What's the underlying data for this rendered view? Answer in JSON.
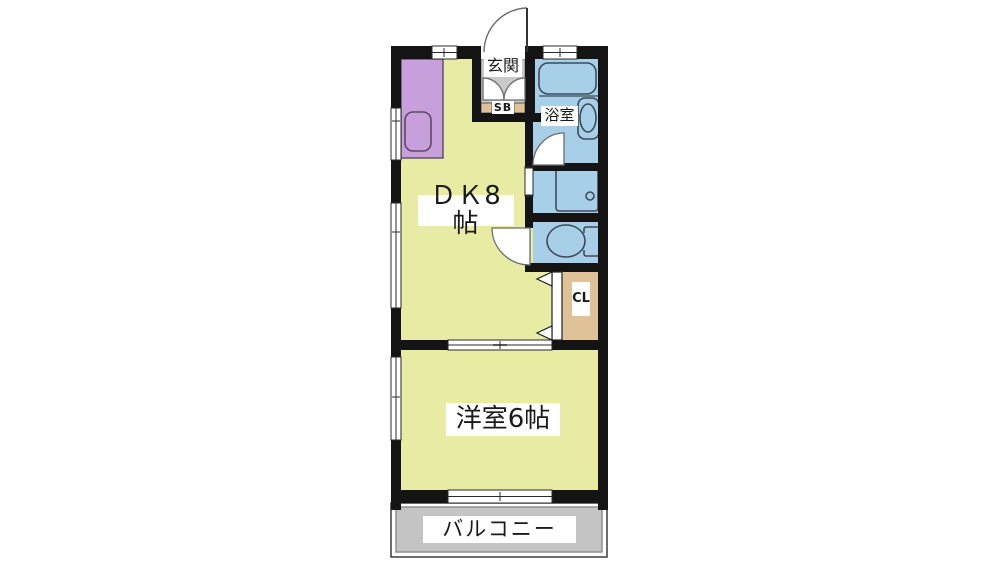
{
  "floorplan": {
    "title": "apartment-floorplan",
    "rooms": {
      "dk": {
        "label": "ＤＫ8帖"
      },
      "western_room": {
        "label": "洋室6帖"
      },
      "entrance": {
        "label": "玄関"
      },
      "bathroom": {
        "label": "浴室"
      },
      "shoe_box": {
        "label": "SB"
      },
      "closet": {
        "label": "CL"
      },
      "balcony": {
        "label": "バルコニー"
      }
    },
    "colors": {
      "wall": "#141414",
      "room_yellow": "#e7eba3",
      "kitchen_purple": "#c79fdb",
      "water_blue": "#a7d0e8",
      "closet_tan": "#e0c298",
      "entrance_gray": "#c9c9c9",
      "balcony_gray": "#c4c4c4",
      "fixture_stroke": "#3d4b58",
      "door_stroke": "#6b6b6b",
      "line_dark": "#2a2a2a"
    }
  }
}
